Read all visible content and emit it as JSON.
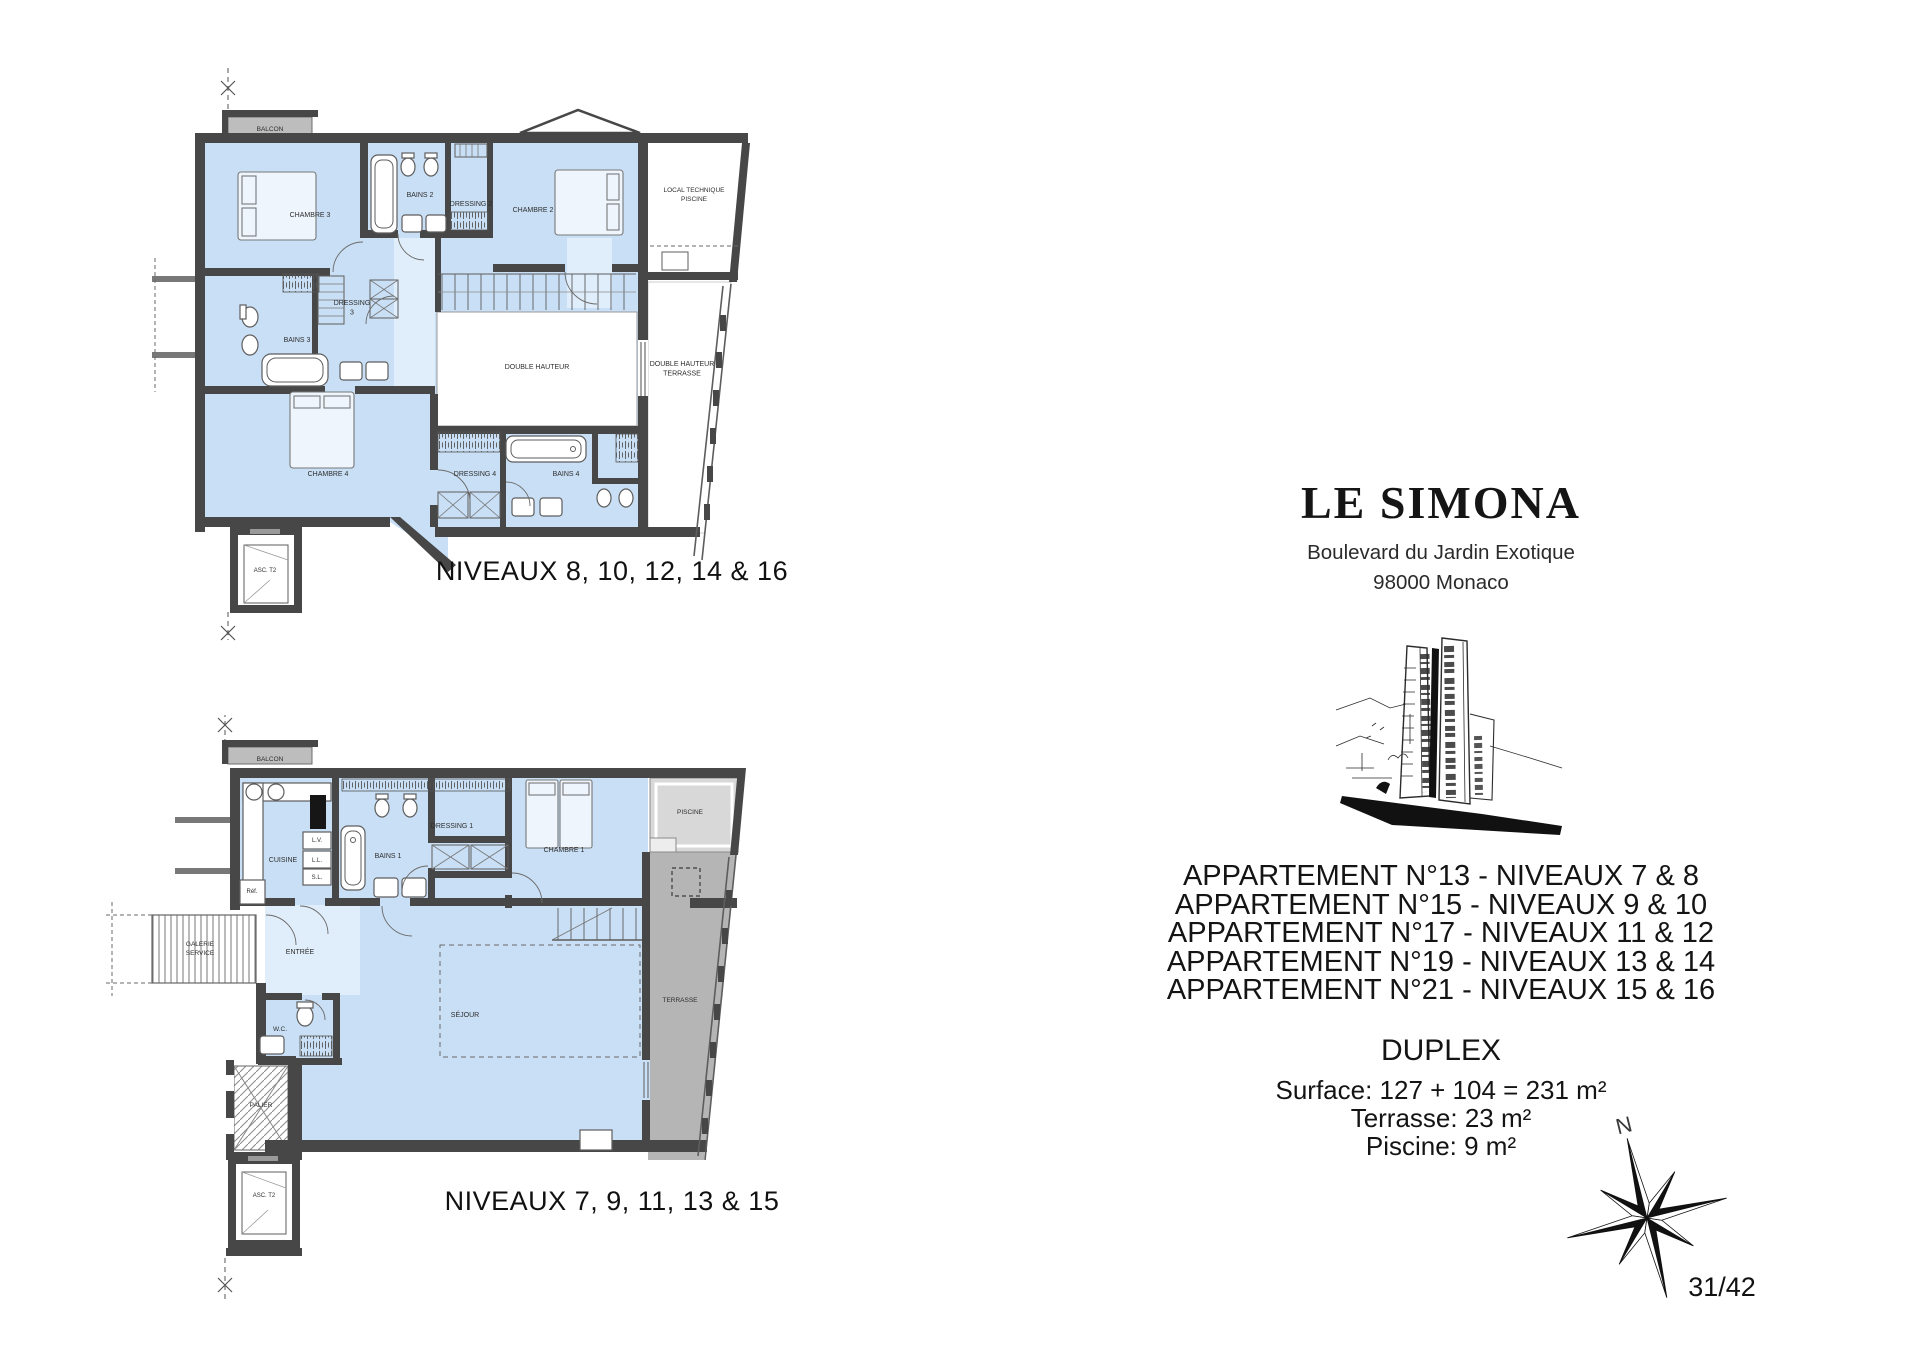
{
  "document": {
    "page_number": "31/42"
  },
  "project": {
    "title": "LE SIMONA",
    "address_line1": "Boulevard du Jardin Exotique",
    "address_line2": "98000 Monaco"
  },
  "apartments": {
    "lines": [
      "APPARTEMENT N°13 - NIVEAUX 7 & 8",
      "APPARTEMENT N°15 - NIVEAUX 9 & 10",
      "APPARTEMENT N°17 - NIVEAUX 11 & 12",
      "APPARTEMENT N°19 - NIVEAUX 13 & 14",
      "APPARTEMENT N°21 - NIVEAUX 15 & 16"
    ],
    "unit_type": "DUPLEX",
    "surface": "Surface: 127 + 104 = 231 m²",
    "terrace": "Terrasse: 23 m²",
    "pool": "Piscine: 9 m²"
  },
  "compass": {
    "north_label": "N"
  },
  "plans": {
    "upper": {
      "caption": "NIVEAUX 8, 10, 12, 14 & 16",
      "labels": [
        {
          "text": "BALCON",
          "x": 270,
          "y": 131,
          "size": 6.5
        },
        {
          "text": "CHAMBRE 3",
          "x": 310,
          "y": 217
        },
        {
          "text": "BAINS 2",
          "x": 420,
          "y": 197
        },
        {
          "text": "DRESSING 2",
          "x": 471,
          "y": 206
        },
        {
          "text": "CHAMBRE 2",
          "x": 533,
          "y": 212
        },
        {
          "text": [
            "LOCAL TECHNIQUE",
            "PISCINE"
          ],
          "x": 694,
          "y": 192,
          "size": 6.5
        },
        {
          "text": [
            "DRESSING",
            "3"
          ],
          "x": 352,
          "y": 305
        },
        {
          "text": "BAINS 3",
          "x": 297,
          "y": 342
        },
        {
          "text": "DOUBLE HAUTEUR",
          "x": 537,
          "y": 369
        },
        {
          "text": [
            "DOUBLE HAUTEUR",
            "TERRASSE"
          ],
          "x": 682,
          "y": 366
        },
        {
          "text": "CHAMBRE 4",
          "x": 328,
          "y": 476
        },
        {
          "text": "DRESSING 4",
          "x": 475,
          "y": 476
        },
        {
          "text": "BAINS 4",
          "x": 566,
          "y": 476
        },
        {
          "text": "ASC. T2",
          "x": 265,
          "y": 572,
          "size": 6
        }
      ]
    },
    "lower": {
      "caption": "NIVEAUX 7, 9, 11, 13 & 15",
      "labels": [
        {
          "text": "BALCON",
          "x": 270,
          "y": 761,
          "size": 6.5
        },
        {
          "text": "CUISINE",
          "x": 283,
          "y": 862
        },
        {
          "text": "L.V.",
          "x": 317,
          "y": 842,
          "size": 6
        },
        {
          "text": "L.L.",
          "x": 317,
          "y": 862,
          "size": 6
        },
        {
          "text": "S.L.",
          "x": 317,
          "y": 879,
          "size": 6
        },
        {
          "text": "Réf.",
          "x": 252,
          "y": 893,
          "size": 6
        },
        {
          "text": "BAINS 1",
          "x": 388,
          "y": 858
        },
        {
          "text": "DRESSING 1",
          "x": 452,
          "y": 828
        },
        {
          "text": "CHAMBRE 1",
          "x": 564,
          "y": 852
        },
        {
          "text": "PISCINE",
          "x": 690,
          "y": 814,
          "size": 6.5
        },
        {
          "text": [
            "GALERIE",
            "SERVICE"
          ],
          "x": 200,
          "y": 946,
          "size": 6.5
        },
        {
          "text": "ENTRÉE",
          "x": 300,
          "y": 954
        },
        {
          "text": "W.C.",
          "x": 280,
          "y": 1031,
          "size": 6.5
        },
        {
          "text": "SÉJOUR",
          "x": 465,
          "y": 1017
        },
        {
          "text": "TERRASSE",
          "x": 680,
          "y": 1002,
          "size": 6.5
        },
        {
          "text": "PALIER",
          "x": 261,
          "y": 1107,
          "size": 6.5
        },
        {
          "text": "ASC. T2",
          "x": 264,
          "y": 1197,
          "size": 6
        }
      ]
    }
  },
  "colors": {
    "room_fill": "#c9dff5",
    "corridor_fill": "#e0edfa",
    "wall": "#474747",
    "balcony_fill": "#bdbdbd",
    "terrace_fill": "#b5b5b5",
    "pool_fill": "#d8d8d8"
  }
}
